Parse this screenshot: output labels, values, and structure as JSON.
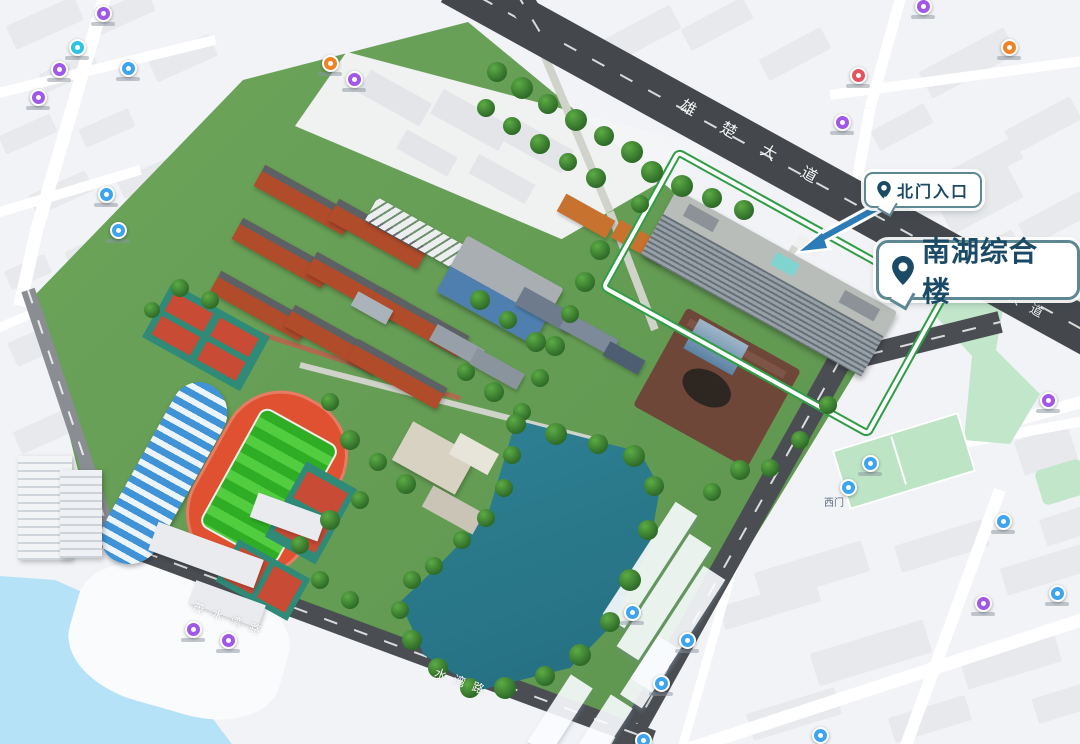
{
  "map": {
    "callouts": {
      "north_gate": {
        "label": "北门入口"
      },
      "main_building": {
        "label": "南湖综合楼"
      }
    },
    "road_labels": {
      "xiongchu": "雄楚大道",
      "xiongchu_short": "大道",
      "shuiwan": "茂水湾路",
      "shuiwan_short": "水湾路"
    },
    "poi_labels": {
      "west_gate": "西门"
    },
    "colors": {
      "callout_border": "#5d8793",
      "callout_text": "#1b4a66",
      "arrow": "#2c7cb8",
      "road": "#44484d",
      "campus_green": "#66a055",
      "lake": "#2b7d8f",
      "track": "#df5130",
      "pitch": "#38b52c",
      "park": "#c2e6ca",
      "water": "#b6e2f8",
      "highlight_outline": "#2f9e47",
      "dorm_brick": "#b14c2b"
    },
    "markers": [
      {
        "x": 103,
        "y": 13,
        "c": "#a158e8"
      },
      {
        "x": 77,
        "y": 47,
        "c": "#2cc3e4"
      },
      {
        "x": 128,
        "y": 68,
        "c": "#3da4f0"
      },
      {
        "x": 59,
        "y": 69,
        "c": "#a158e8"
      },
      {
        "x": 38,
        "y": 97,
        "c": "#a158e8"
      },
      {
        "x": 106,
        "y": 194,
        "c": "#3da4f0"
      },
      {
        "x": 118,
        "y": 230,
        "c": "#3da4f0"
      },
      {
        "x": 330,
        "y": 63,
        "c": "#f08223"
      },
      {
        "x": 354,
        "y": 79,
        "c": "#a158e8"
      },
      {
        "x": 923,
        "y": 6,
        "c": "#a158e8"
      },
      {
        "x": 858,
        "y": 75,
        "c": "#e4525e"
      },
      {
        "x": 842,
        "y": 122,
        "c": "#a158e8"
      },
      {
        "x": 1009,
        "y": 47,
        "c": "#f08223"
      },
      {
        "x": 1048,
        "y": 400,
        "c": "#a158e8"
      },
      {
        "x": 870,
        "y": 463,
        "c": "#3da4f0"
      },
      {
        "x": 848,
        "y": 487,
        "c": "#3da4f0",
        "s": 0
      },
      {
        "x": 1003,
        "y": 521,
        "c": "#3da4f0"
      },
      {
        "x": 1057,
        "y": 593,
        "c": "#3da4f0"
      },
      {
        "x": 983,
        "y": 603,
        "c": "#a158e8"
      },
      {
        "x": 632,
        "y": 612,
        "c": "#3da4f0"
      },
      {
        "x": 687,
        "y": 640,
        "c": "#3da4f0"
      },
      {
        "x": 661,
        "y": 683,
        "c": "#3da4f0"
      },
      {
        "x": 643,
        "y": 740,
        "c": "#3da4f0"
      },
      {
        "x": 820,
        "y": 735,
        "c": "#3da4f0"
      },
      {
        "x": 193,
        "y": 629,
        "c": "#a158e8"
      },
      {
        "x": 228,
        "y": 640,
        "c": "#a158e8"
      }
    ]
  }
}
